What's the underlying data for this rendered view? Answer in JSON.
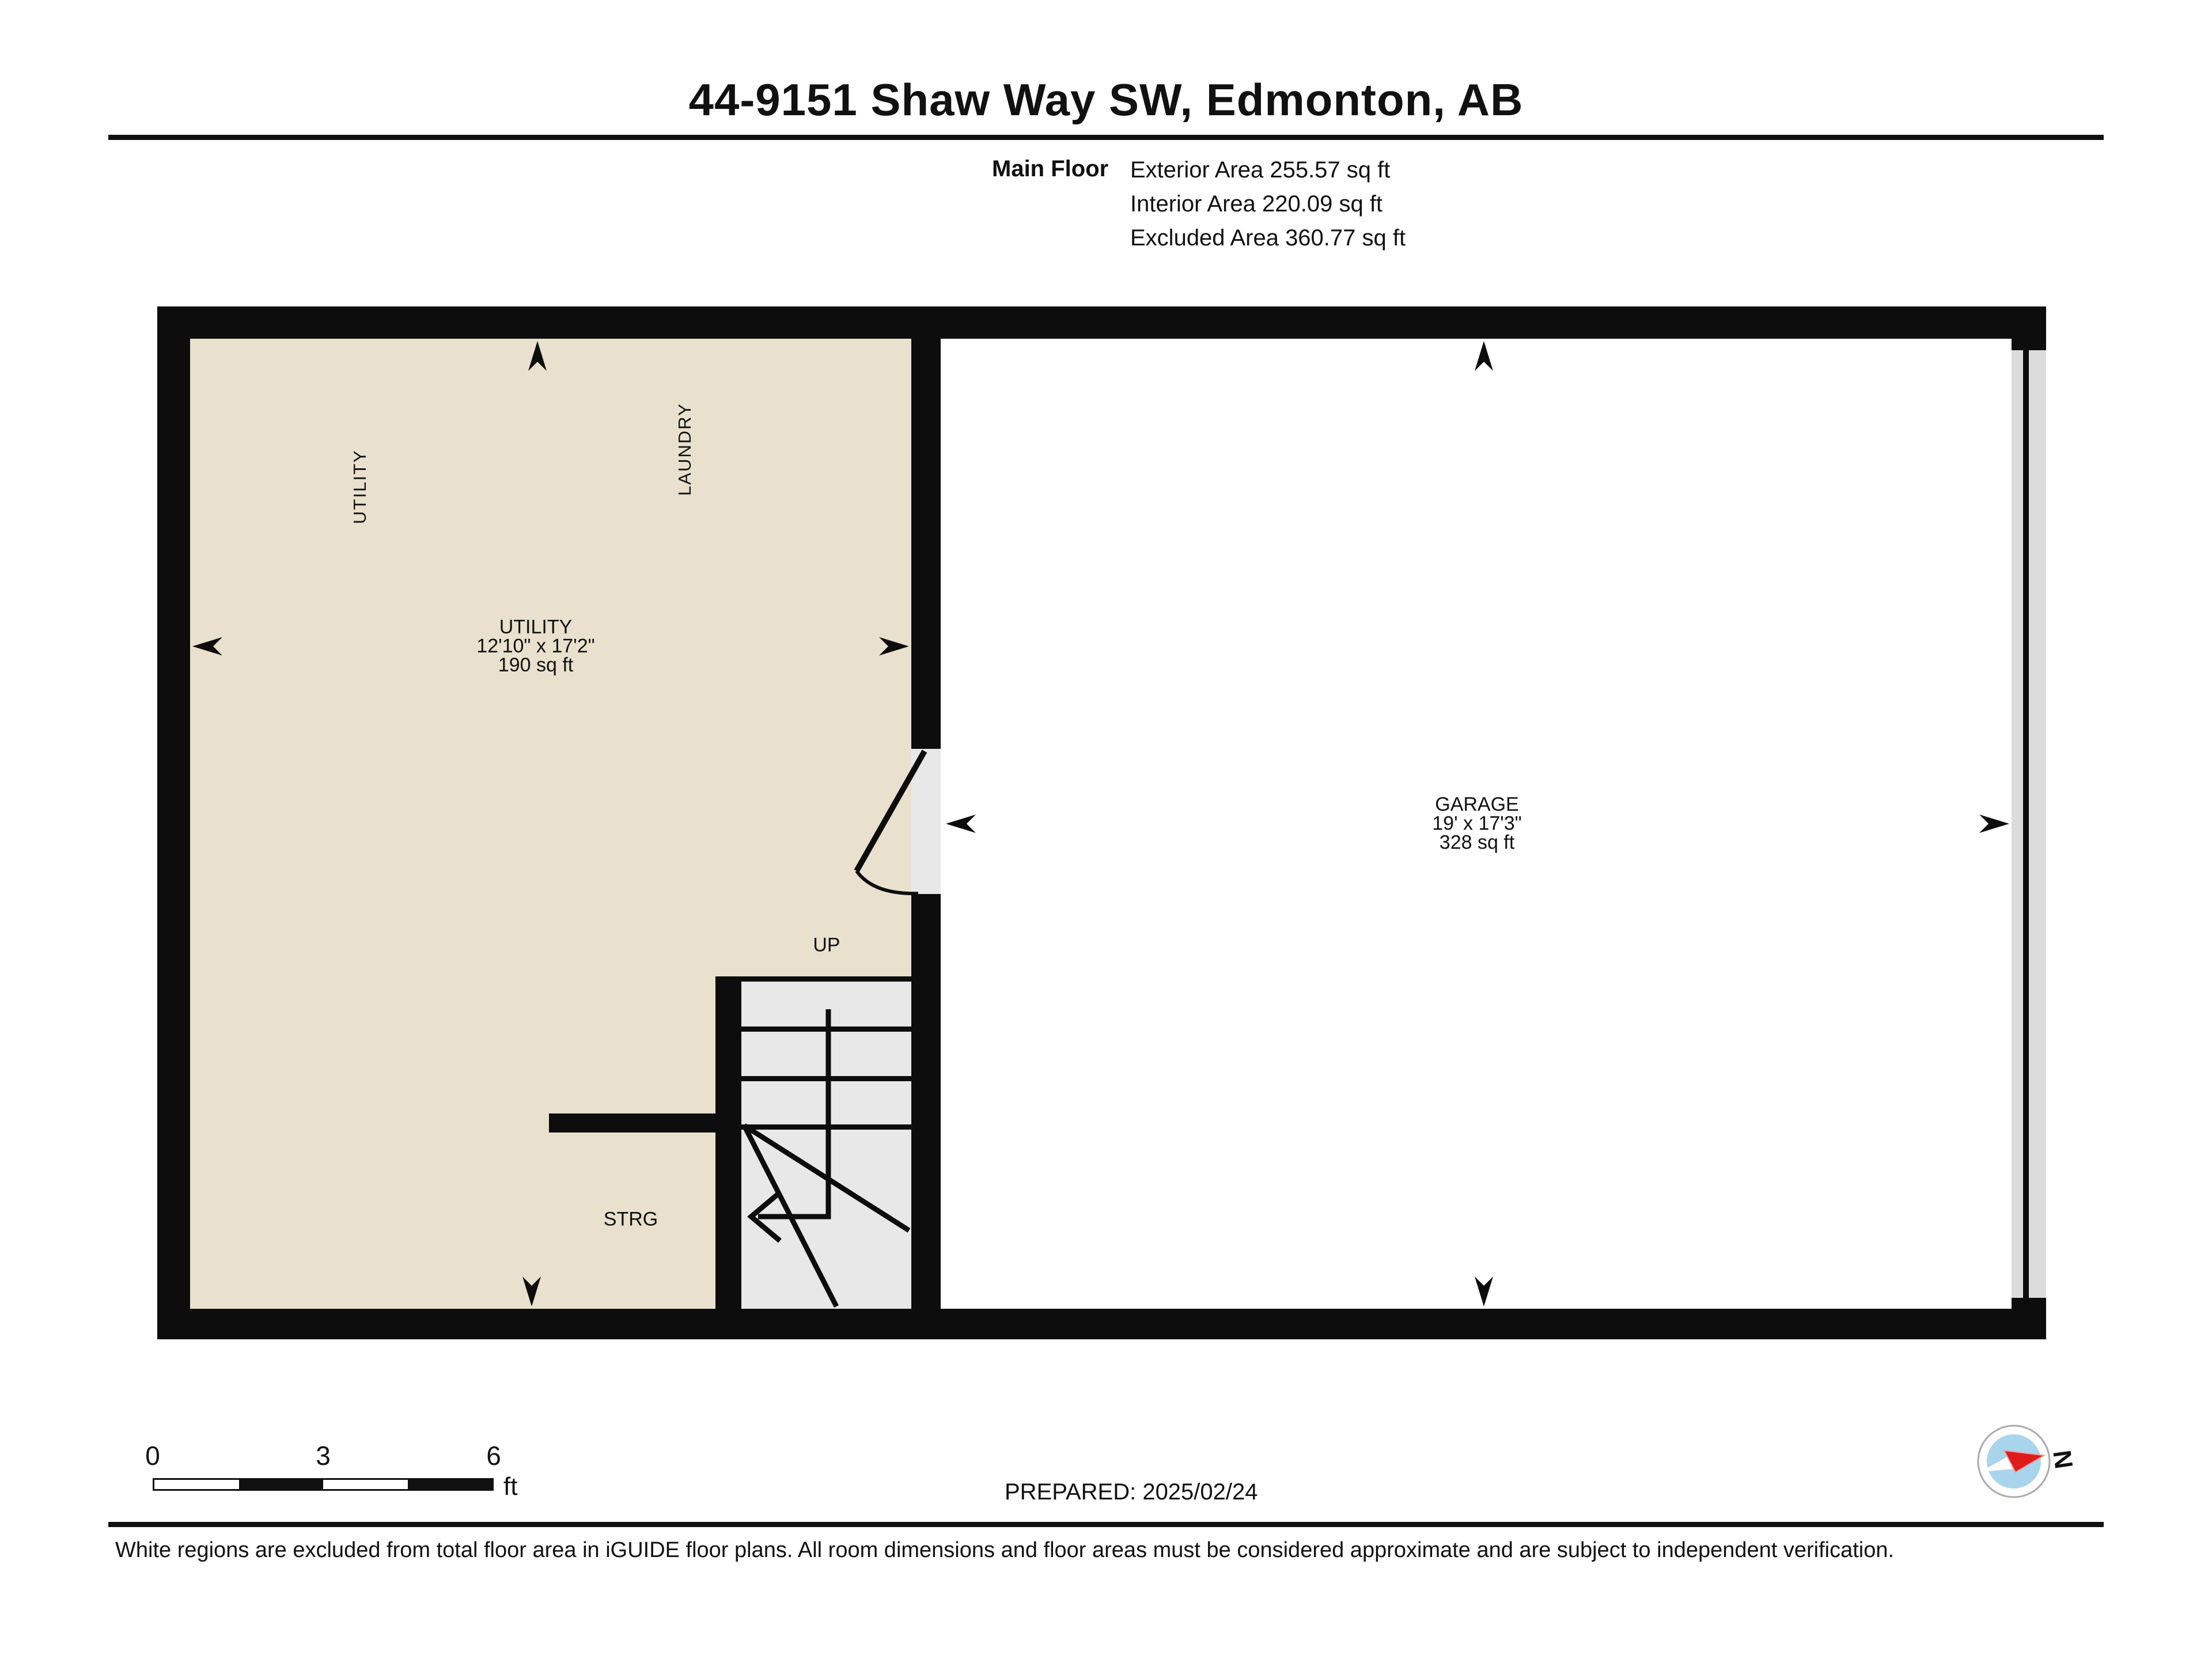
{
  "header": {
    "title": "44-9151 Shaw Way SW, Edmonton, AB",
    "floor_label": "Main Floor",
    "areas": [
      "Exterior Area 255.57 sq ft",
      "Interior Area 220.09 sq ft",
      "Excluded Area 360.77 sq ft"
    ]
  },
  "plan": {
    "rooms": [
      {
        "id": "utility",
        "name": "UTILITY",
        "dimensions": "12'10\" x 17'2\"",
        "area": "190 sq ft"
      },
      {
        "id": "garage",
        "name": "GARAGE",
        "dimensions": "19' x 17'3\"",
        "area": "328 sq ft"
      }
    ],
    "annotations": {
      "utility_wall_label": "UTILITY",
      "laundry_wall_label": "LAUNDRY",
      "stairs_direction": "UP",
      "storage_label": "STRG"
    }
  },
  "scale_bar": {
    "ticks": [
      "0",
      "3",
      "6"
    ],
    "unit": "ft"
  },
  "footer": {
    "prepared_label": "PREPARED: 2025/02/24",
    "compass_north_label": "N",
    "disclaimer": "White regions are excluded from total floor area in iGUIDE floor plans. All room dimensions and floor areas must be considered approximate and are subject to independent verification."
  },
  "colors": {
    "wall": "#0d0d0d",
    "included_room_fill": "#e9e1cd",
    "stairs_fill": "#e8e8e8",
    "garage_door_fill": "#dcdcdc",
    "compass_blue": "#a9d5ec",
    "compass_red": "#e01b1b"
  }
}
